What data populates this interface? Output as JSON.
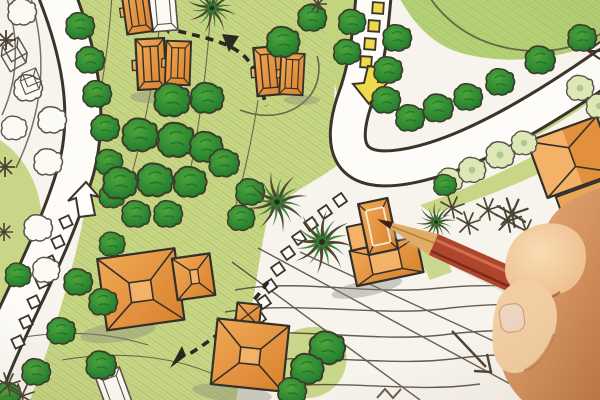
{
  "image": {
    "kind": "photograph",
    "subject": "hand-drawn-landscape-architecture-site-plan-with-hand-holding-red-pencil",
    "width": 600,
    "height": 400
  },
  "palette": {
    "paper": "#f7f4ed",
    "ground": "#c9d687",
    "ground2": "#c3d47f",
    "lawn": "#b5d178",
    "scribble": "#9abb55",
    "treeFill1": "#4ea53c",
    "treeFill2": "#17752a",
    "treeOutline": "#3d3b2b",
    "treePaper": "#fbfaf4",
    "treeTint": "#dde8b6",
    "sketch": "#575349",
    "roadLine": "#3a342b",
    "roadFill": "#fdfcf8",
    "yellow": "#f0d94a",
    "orange": "#e2903b",
    "orangeDark": "#c4681f",
    "orangeLight": "#f3b267",
    "houseLine": "#33302a",
    "dash": "#2b2721",
    "contour": "#4c4337",
    "palmDark": "#4e4a32",
    "palmGreen": "#2f7d33",
    "fernDark": "#4a4434",
    "skinDark": "#c27a45",
    "skinMid": "#eab080",
    "skinPale": "#f8dcb4",
    "thumbPale": "#f3cda3",
    "nail": "#ecd5c1",
    "pencilRed": "#b0452e",
    "pencilRedDark": "#7c2b18",
    "pencilRedLight": "#d37452",
    "wood": "#e0ac66",
    "woodDark": "#b5823f",
    "lead": "#3a2314",
    "shadowGray": "#8a8a7a"
  },
  "scene": {
    "trees_green": [
      [
        80,
        26,
        1
      ],
      [
        90,
        60,
        1
      ],
      [
        97,
        94,
        1
      ],
      [
        105,
        128,
        1
      ],
      [
        109,
        162,
        0.95
      ],
      [
        112,
        196,
        0.9
      ],
      [
        112,
        244,
        0.9
      ],
      [
        18,
        275,
        0.9
      ],
      [
        78,
        282,
        1
      ],
      [
        103,
        302,
        1
      ],
      [
        61,
        331,
        1
      ],
      [
        101,
        365,
        1.05
      ],
      [
        36,
        372,
        1
      ],
      [
        8,
        394,
        0.9
      ],
      [
        172,
        100,
        1.25
      ],
      [
        207,
        98,
        1.15
      ],
      [
        140,
        135,
        1.25
      ],
      [
        176,
        140,
        1.3
      ],
      [
        206,
        147,
        1.15
      ],
      [
        120,
        183,
        1.2
      ],
      [
        155,
        180,
        1.25
      ],
      [
        190,
        182,
        1.15
      ],
      [
        224,
        163,
        1.05
      ],
      [
        136,
        214,
        1
      ],
      [
        168,
        214,
        1
      ],
      [
        250,
        192,
        1
      ],
      [
        241,
        218,
        0.95
      ],
      [
        283,
        42,
        1.15
      ],
      [
        312,
        18,
        1
      ],
      [
        352,
        22,
        0.95
      ],
      [
        347,
        52,
        0.95
      ],
      [
        397,
        38,
        1
      ],
      [
        388,
        70,
        1
      ],
      [
        386,
        100,
        1
      ],
      [
        410,
        118,
        1
      ],
      [
        438,
        108,
        1.05
      ],
      [
        468,
        97,
        1
      ],
      [
        500,
        82,
        1
      ],
      [
        540,
        60,
        1.05
      ],
      [
        582,
        38,
        1
      ],
      [
        327,
        348,
        1.25
      ],
      [
        307,
        369,
        1.15
      ],
      [
        292,
        391,
        1
      ],
      [
        445,
        185,
        0.8
      ]
    ],
    "trees_outline": [
      [
        22,
        12,
        1
      ],
      [
        28,
        88,
        1
      ],
      [
        52,
        120,
        1
      ],
      [
        14,
        128,
        0.9
      ],
      [
        48,
        162,
        1
      ],
      [
        38,
        228,
        1
      ],
      [
        46,
        270,
        0.95
      ]
    ],
    "trees_tinted": [
      [
        450,
        180,
        0.9
      ],
      [
        472,
        170,
        0.95
      ],
      [
        500,
        155,
        1
      ],
      [
        580,
        88,
        0.95
      ],
      [
        599,
        106,
        0.9
      ],
      [
        524,
        143,
        0.9
      ]
    ],
    "conifers": [
      [
        6,
        40,
        1
      ],
      [
        5,
        167,
        1
      ],
      [
        4,
        232,
        0.9
      ],
      [
        318,
        4,
        0.9
      ]
    ],
    "palms": [
      [
        277,
        202,
        1.15,
        -8
      ],
      [
        322,
        242,
        1.2,
        12
      ],
      [
        436,
        222,
        0.75,
        0
      ],
      [
        212,
        8,
        0.95,
        20
      ]
    ],
    "ferns": [
      [
        452,
        208,
        1
      ],
      [
        468,
        224,
        1
      ],
      [
        488,
        210,
        1
      ],
      [
        508,
        221,
        1.1
      ],
      [
        526,
        231,
        1
      ],
      [
        512,
        214,
        1.3
      ],
      [
        8,
        385,
        1
      ],
      [
        22,
        396,
        1
      ]
    ],
    "squares_trail": [
      [
        340,
        200
      ],
      [
        325,
        212
      ],
      [
        311,
        224
      ],
      [
        299,
        238
      ],
      [
        288,
        253
      ],
      [
        278,
        269
      ],
      [
        270,
        286
      ],
      [
        264,
        302
      ],
      [
        259,
        318
      ]
    ],
    "squares_road": [
      [
        66,
        222
      ],
      [
        58,
        242
      ],
      [
        50,
        262
      ],
      [
        42,
        282
      ],
      [
        34,
        302
      ],
      [
        26,
        322
      ],
      [
        18,
        342
      ]
    ],
    "squares_yellow": [
      [
        378,
        8
      ],
      [
        374,
        26
      ],
      [
        370,
        44
      ],
      [
        366,
        62
      ]
    ],
    "houses_small": [
      [
        137,
        10,
        -8,
        1
      ],
      [
        151,
        64,
        -3,
        1.1
      ],
      [
        178,
        63,
        2,
        0.95
      ],
      [
        269,
        71,
        -5,
        1.05
      ],
      [
        292,
        74,
        3,
        0.9
      ]
    ],
    "houses_outline_small": [
      [
        163,
        8,
        -5,
        1
      ],
      [
        115,
        393,
        -20,
        1
      ]
    ],
    "cubes": [
      [
        14,
        58,
        -30,
        1
      ],
      [
        30,
        84,
        -22,
        0.8
      ]
    ],
    "shadows": [
      [
        118,
        332,
        38,
        10,
        -8
      ],
      [
        232,
        393,
        40,
        9,
        6
      ],
      [
        367,
        288,
        36,
        8,
        -12
      ],
      [
        150,
        97,
        20,
        6,
        0
      ],
      [
        302,
        100,
        18,
        5,
        0
      ]
    ]
  }
}
